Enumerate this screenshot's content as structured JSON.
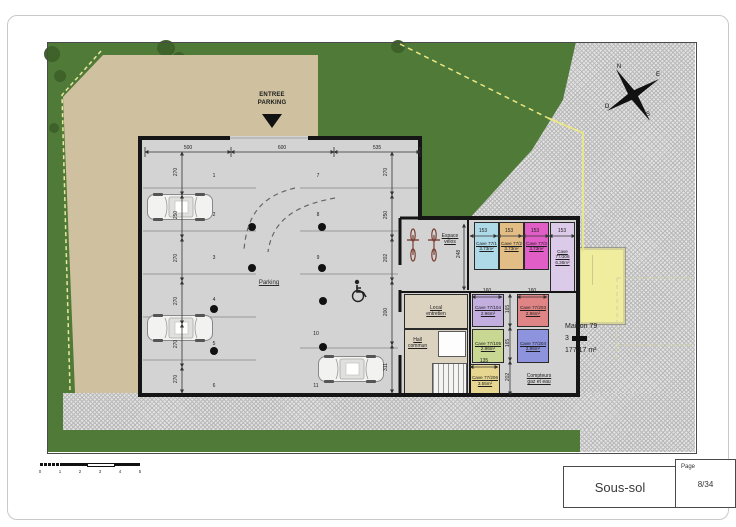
{
  "title_block": {
    "plan_name": "Sous-sol",
    "page_label": "Page",
    "page_number": "8/34"
  },
  "compass": {
    "n": "N",
    "e": "E",
    "o": "O",
    "s": "S"
  },
  "scale_bar": {
    "ticks": [
      "0",
      "1",
      "2",
      "3",
      "4",
      "5"
    ]
  },
  "site": {
    "entrance_line1": "ENTREE",
    "entrance_line2": "PARKING",
    "grass_color": "#507a38",
    "driveway_color": "#cfc19f"
  },
  "garage": {
    "label": "Parking",
    "floor_color": "#d3d3d3",
    "spot_numbers": [
      "1",
      "2",
      "3",
      "4",
      "5",
      "6",
      "7",
      "8",
      "9",
      "10",
      "11"
    ],
    "bike_line1": "Espace",
    "bike_line2": "vélos",
    "local_line1": "Local",
    "local_line2": "entretien",
    "hall_line1": "Hall",
    "hall_line2": "commun",
    "meters_line1": "Compteurs",
    "meters_line2": "gaz et eau"
  },
  "dimensions": {
    "top": [
      "500",
      "600",
      "535"
    ],
    "left": [
      "270",
      "250",
      "270",
      "270",
      "270",
      "270"
    ],
    "right": [
      "270",
      "250",
      "202",
      "200",
      "311"
    ],
    "bike_depth": "248",
    "cave_row": [
      "153",
      "153",
      "153",
      "153"
    ],
    "cave_lower_widths": [
      "160",
      "160"
    ],
    "cave_lower_width_small": "135",
    "cave_lower_heights": [
      "165",
      "165",
      "202"
    ]
  },
  "caves": [
    {
      "name": "Cave 77/1",
      "area": "3.73m²",
      "color": "#aed9e6"
    },
    {
      "name": "Cave 77/2",
      "area": "3.73m²",
      "color": "#e2bd85"
    },
    {
      "name": "Cave 77/3",
      "area": "3.73m²",
      "color": "#e05ec6"
    },
    {
      "name": "Cave 77/306",
      "area": "6.36m²",
      "color": "#dccbe8"
    },
    {
      "name": "Cave 77/104",
      "area": "2.96m²",
      "color": "#c3aee0"
    },
    {
      "name": "Cave 77/203",
      "area": "2.96m²",
      "color": "#e08585"
    },
    {
      "name": "Cave 77/105",
      "area": "2.96m²",
      "color": "#c8d893"
    },
    {
      "name": "Cave 77/204",
      "area": "2.96m²",
      "color": "#8d93dd"
    },
    {
      "name": "Cave 77/206",
      "area": "3.55m²",
      "color": "#e6d68f"
    }
  ],
  "maison": {
    "name": "Maison 79",
    "levels": "3",
    "area": "177.17 m²",
    "color": "#f0ed9f"
  }
}
